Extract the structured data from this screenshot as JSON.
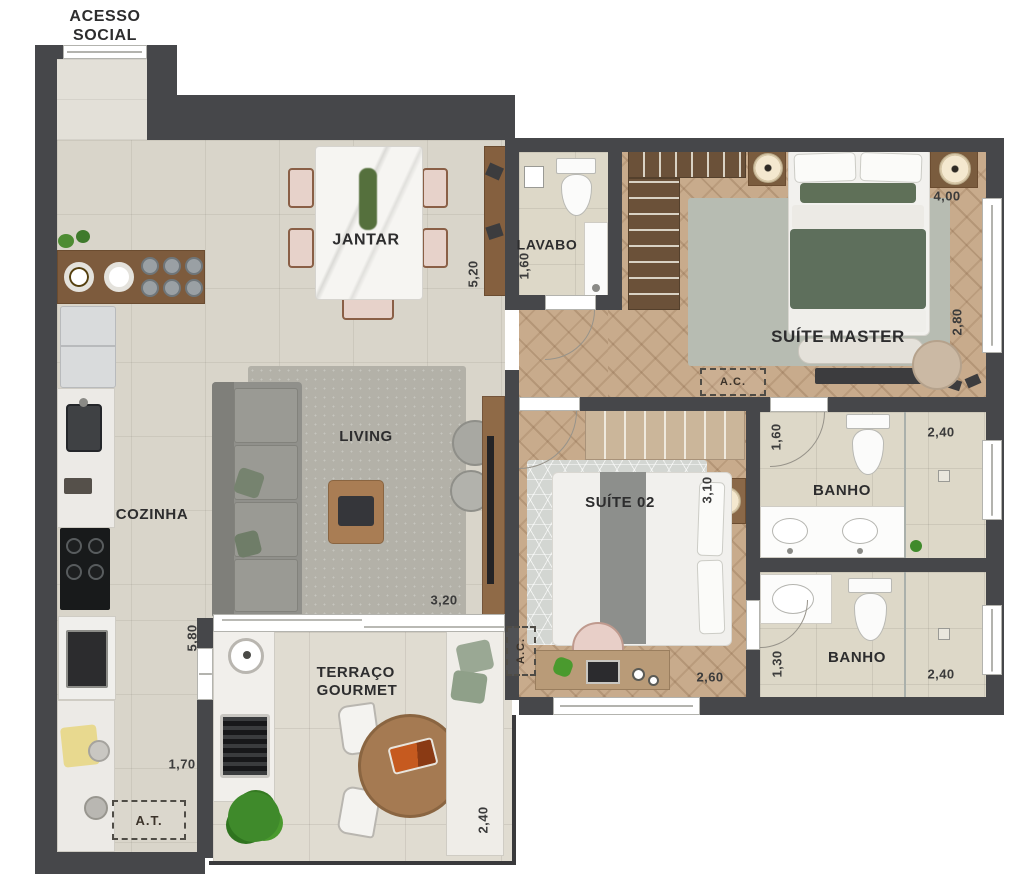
{
  "plan_type": "apartment floor plan",
  "entry": {
    "label": "ACESSO\nSOCIAL"
  },
  "rooms": {
    "jantar": "JANTAR",
    "lavabo": "LAVABO",
    "suite_master": "SUÍTE MASTER",
    "cozinha": "COZINHA",
    "living": "LIVING",
    "suite_02": "SUÍTE 02",
    "banho_1": "BANHO",
    "banho_2": "BANHO",
    "terraco_gourmet": "TERRAÇO\nGOURMET",
    "area_tecnica": "A.T.",
    "ac_suite_master": "A.C.",
    "ac_suite_02": "A.C."
  },
  "dimensions": {
    "jantar_depth": "5,20",
    "lavabo_width": "1,60",
    "suite_master_width": "4,00",
    "suite_master_depth": "2,80",
    "banho_1_width": "1,60",
    "banho_1_length": "2,40",
    "suite_02_depth": "3,10",
    "suite_02_width": "2,60",
    "banho_2_width": "1,30",
    "banho_2_length": "2,40",
    "living_width": "3,20",
    "cozinha_depth": "5,80",
    "cozinha_width": "1,70",
    "terraco_depth": "2,40"
  },
  "colors": {
    "wall": "#46474a",
    "tile_floor": "#d9d5ca",
    "wood_floor": "#c8ab8c",
    "bath_floor": "#ddd8c8",
    "terrace_floor": "#e0dcd1",
    "duvet_green": "#5e6f5c",
    "chair_blush": "#e7d2ca",
    "plant_green": "#3f8a2b",
    "label_text": "#2d2d2e"
  }
}
